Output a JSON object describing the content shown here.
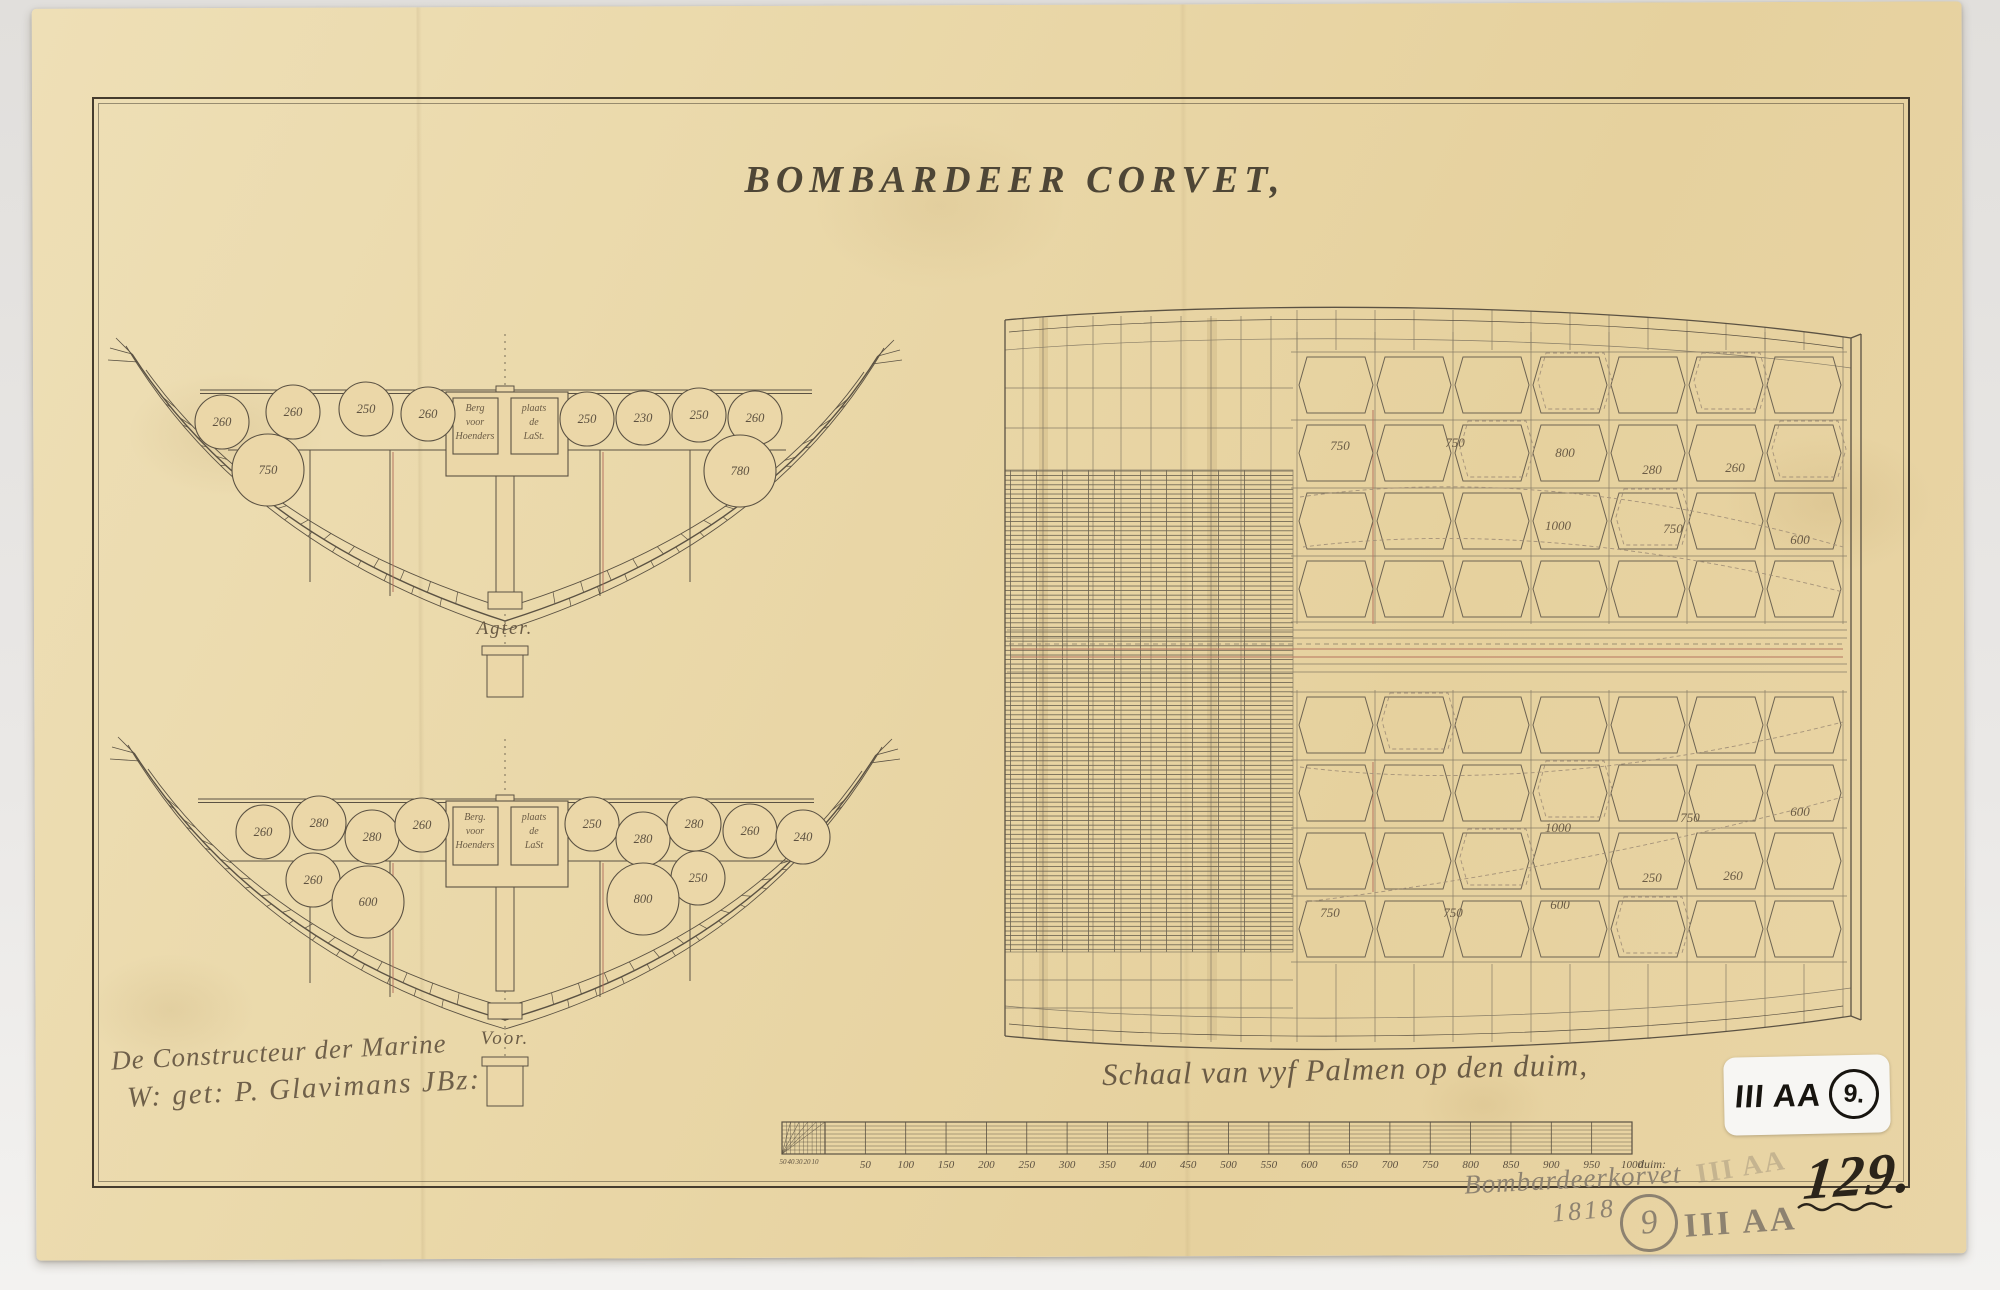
{
  "title": "BOMBARDEER CORVET,",
  "colors": {
    "paper": "#e9d5a5",
    "ink": "#5b5243",
    "handwriting": "#6a5b45",
    "pencil": "#8d8270",
    "red_accent": "#b5745f",
    "marker": "#17140f"
  },
  "cross_sections": [
    {
      "id": "agter",
      "label": "Agter.",
      "box_left_lines": [
        "Berg",
        "voor",
        "Hoenders"
      ],
      "box_right_lines": [
        "plaats",
        "de",
        "LaSt."
      ],
      "barrels_small": [
        "260",
        "260",
        "250",
        "260",
        "250",
        "230",
        "250",
        "260"
      ],
      "barrels_large": [
        "750",
        "780"
      ]
    },
    {
      "id": "voor",
      "label": "Voor.",
      "box_left_lines": [
        "Berg.",
        "voor",
        "Hoenders"
      ],
      "box_right_lines": [
        "plaats",
        "de",
        "LaSt"
      ],
      "barrels_small": [
        "260",
        "280",
        "280",
        "260",
        "250",
        "280",
        "280",
        "260",
        "240"
      ],
      "barrels_row2": [
        "260",
        "250"
      ],
      "barrels_large": [
        "600",
        "800"
      ]
    }
  ],
  "plan": {
    "labels_top": [
      "750",
      "750",
      "800",
      "280",
      "260",
      "1000",
      "750",
      "600"
    ],
    "labels_bottom": [
      "1000",
      "750",
      "600",
      "250",
      "260",
      "750",
      "750",
      "600"
    ]
  },
  "scale": {
    "caption": "Schaal van vyf Palmen op den duim,",
    "minor_ticks": [
      "50",
      "40",
      "30",
      "20",
      "10"
    ],
    "major_ticks": [
      "50",
      "100",
      "150",
      "200",
      "250",
      "300",
      "350",
      "400",
      "450",
      "500",
      "550",
      "600",
      "650",
      "700",
      "750",
      "800",
      "850",
      "900",
      "950",
      "1000"
    ],
    "unit": "duim:"
  },
  "signature": {
    "line1": "De Constructeur der Marine",
    "line2": "W: get: P. Glavimans JBz:"
  },
  "annotations": {
    "sticker_class": "III AA",
    "sticker_number": "9.",
    "ink_number": "129.",
    "pencil_class_faint": "III AA",
    "pencil_title": "Bombardeerkorvet",
    "pencil_year": "1818",
    "pencil_circle_number": "9",
    "pencil_class": "III AA"
  }
}
